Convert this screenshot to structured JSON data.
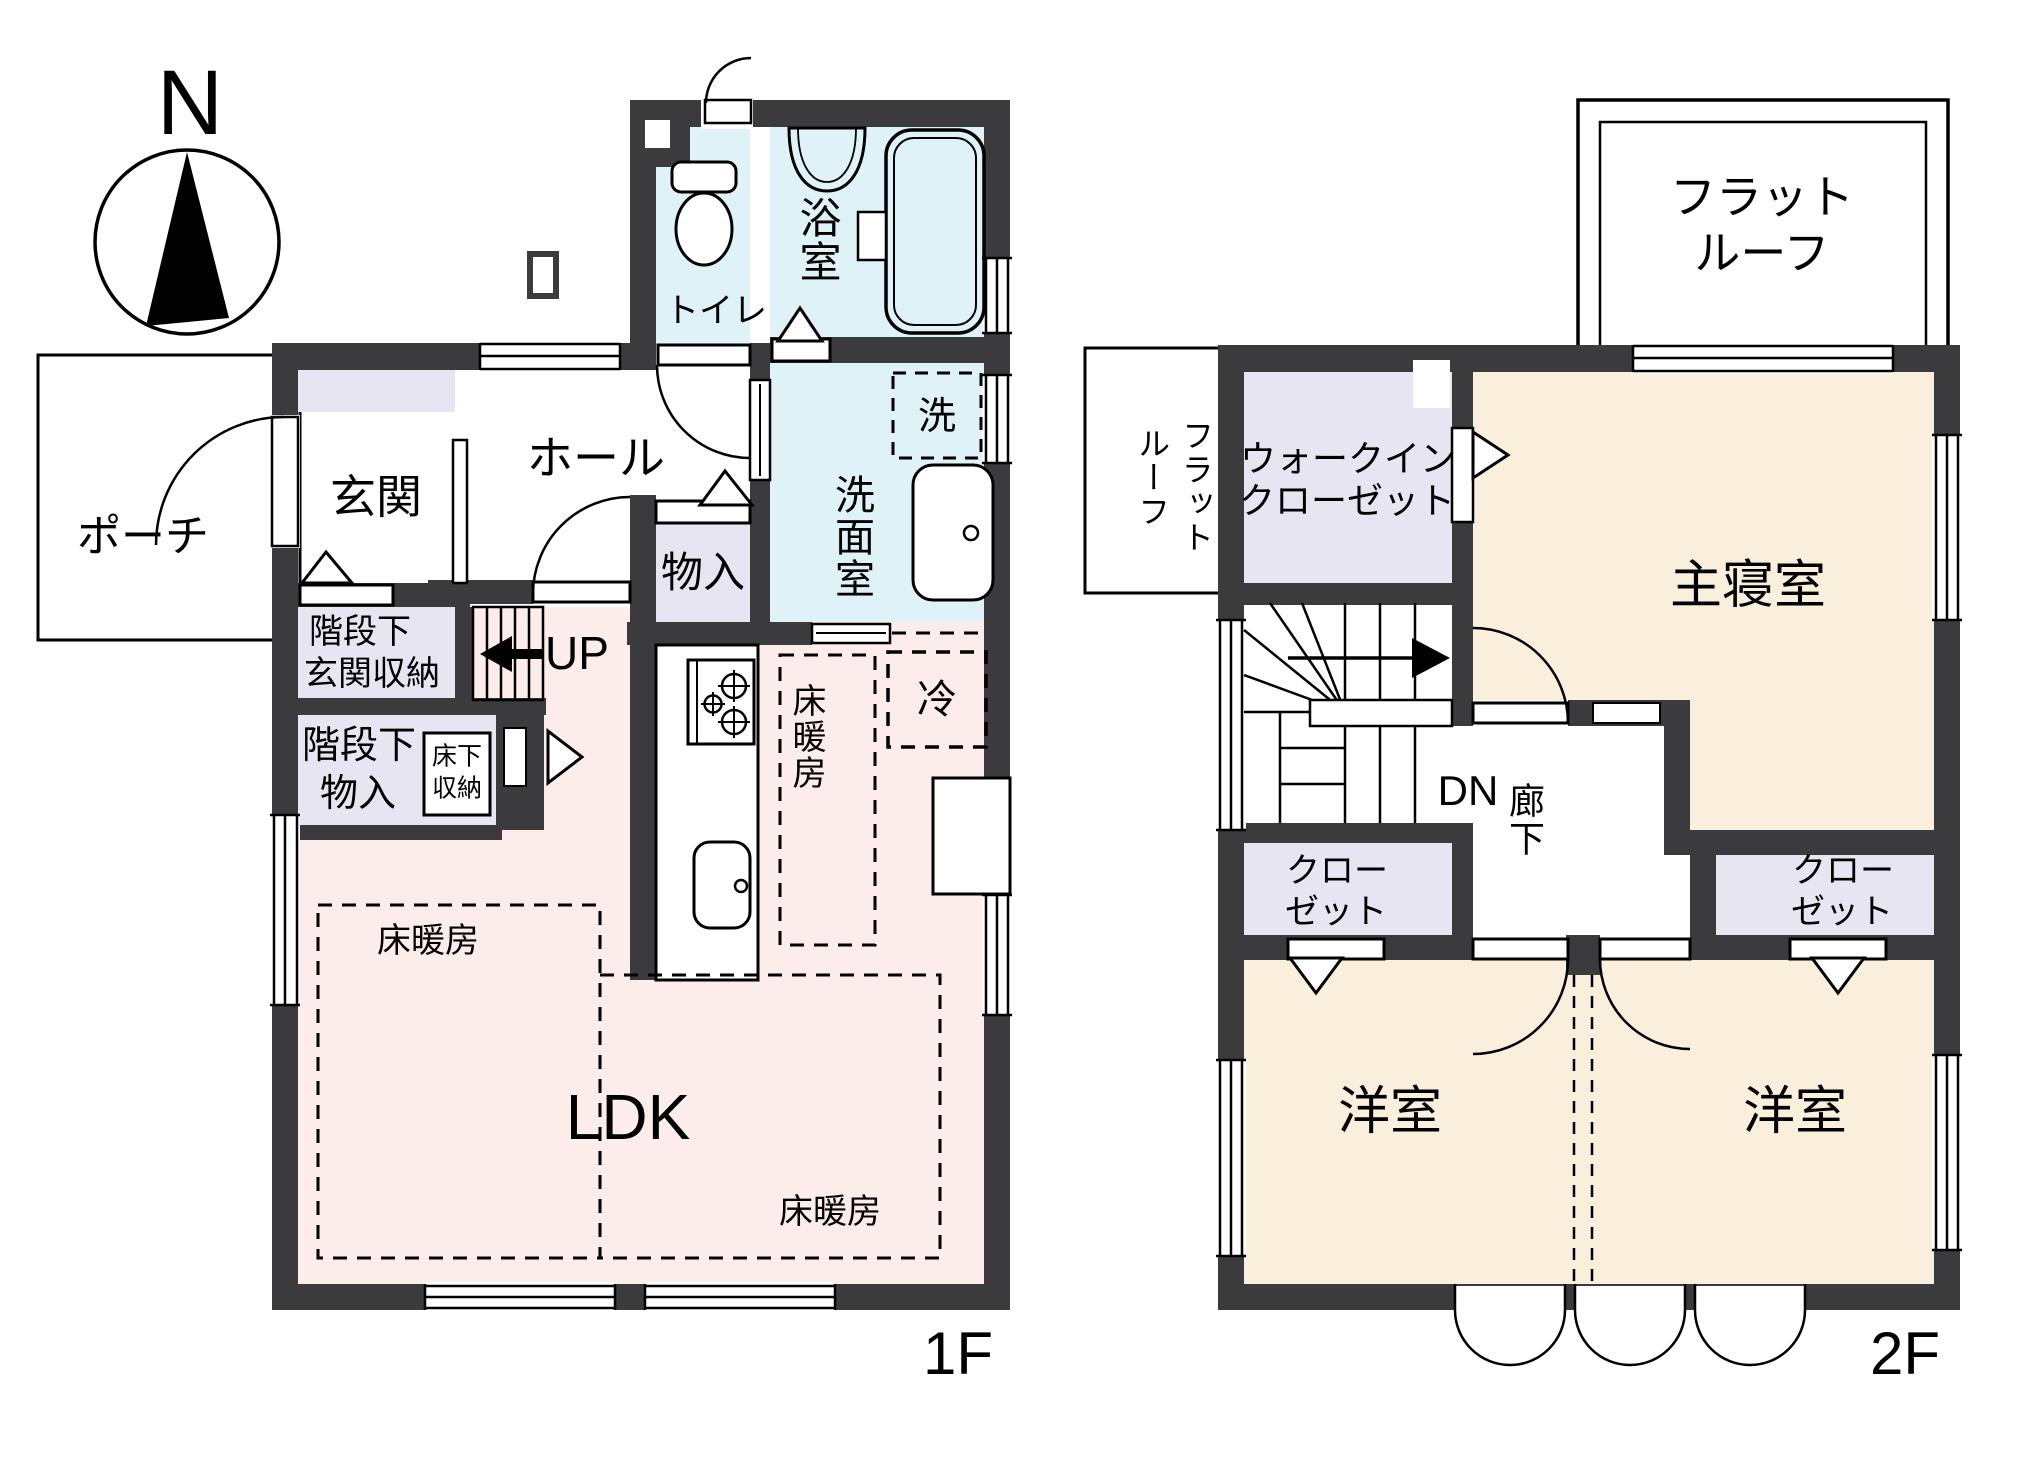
{
  "title": "間取り図",
  "colors": {
    "wall": "#3b3b3d",
    "water": "#def2f7",
    "storage": "#e7e5f2",
    "ldk": "#fdedea",
    "bedroom": "#faeedc"
  },
  "compass": {
    "north": "N"
  },
  "floor1": {
    "floor_label": "1F",
    "porch": "ポーチ",
    "entrance": "玄関",
    "hall": "ホール",
    "toilet": "トイレ",
    "bath": "浴室",
    "washroom": "洗面室",
    "laundry": "洗",
    "hall_closet": "物入",
    "understair_entrance_l1": "階段下",
    "understair_entrance_l2": "玄関収納",
    "understair_closet_l1": "階段下",
    "understair_closet_l2": "物入",
    "underfloor_l1": "床下",
    "underfloor_l2": "収納",
    "stairs_up": "UP",
    "ldk": "LDK",
    "floor_heating": "床暖房",
    "fridge": "冷"
  },
  "floor2": {
    "floor_label": "2F",
    "flat_roof_l1": "フラット",
    "flat_roof_l2": "ルーフ",
    "flat_roof_side_c1": "フラット",
    "flat_roof_side_c2": "ルーフ",
    "wic_l1": "ウォークイン",
    "wic_l2": "クローゼット",
    "master_bedroom": "主寝室",
    "stairs_down": "DN",
    "corridor": "廊下",
    "closet_l1": "クロー",
    "closet_l2": "ゼット",
    "western_room": "洋室"
  }
}
